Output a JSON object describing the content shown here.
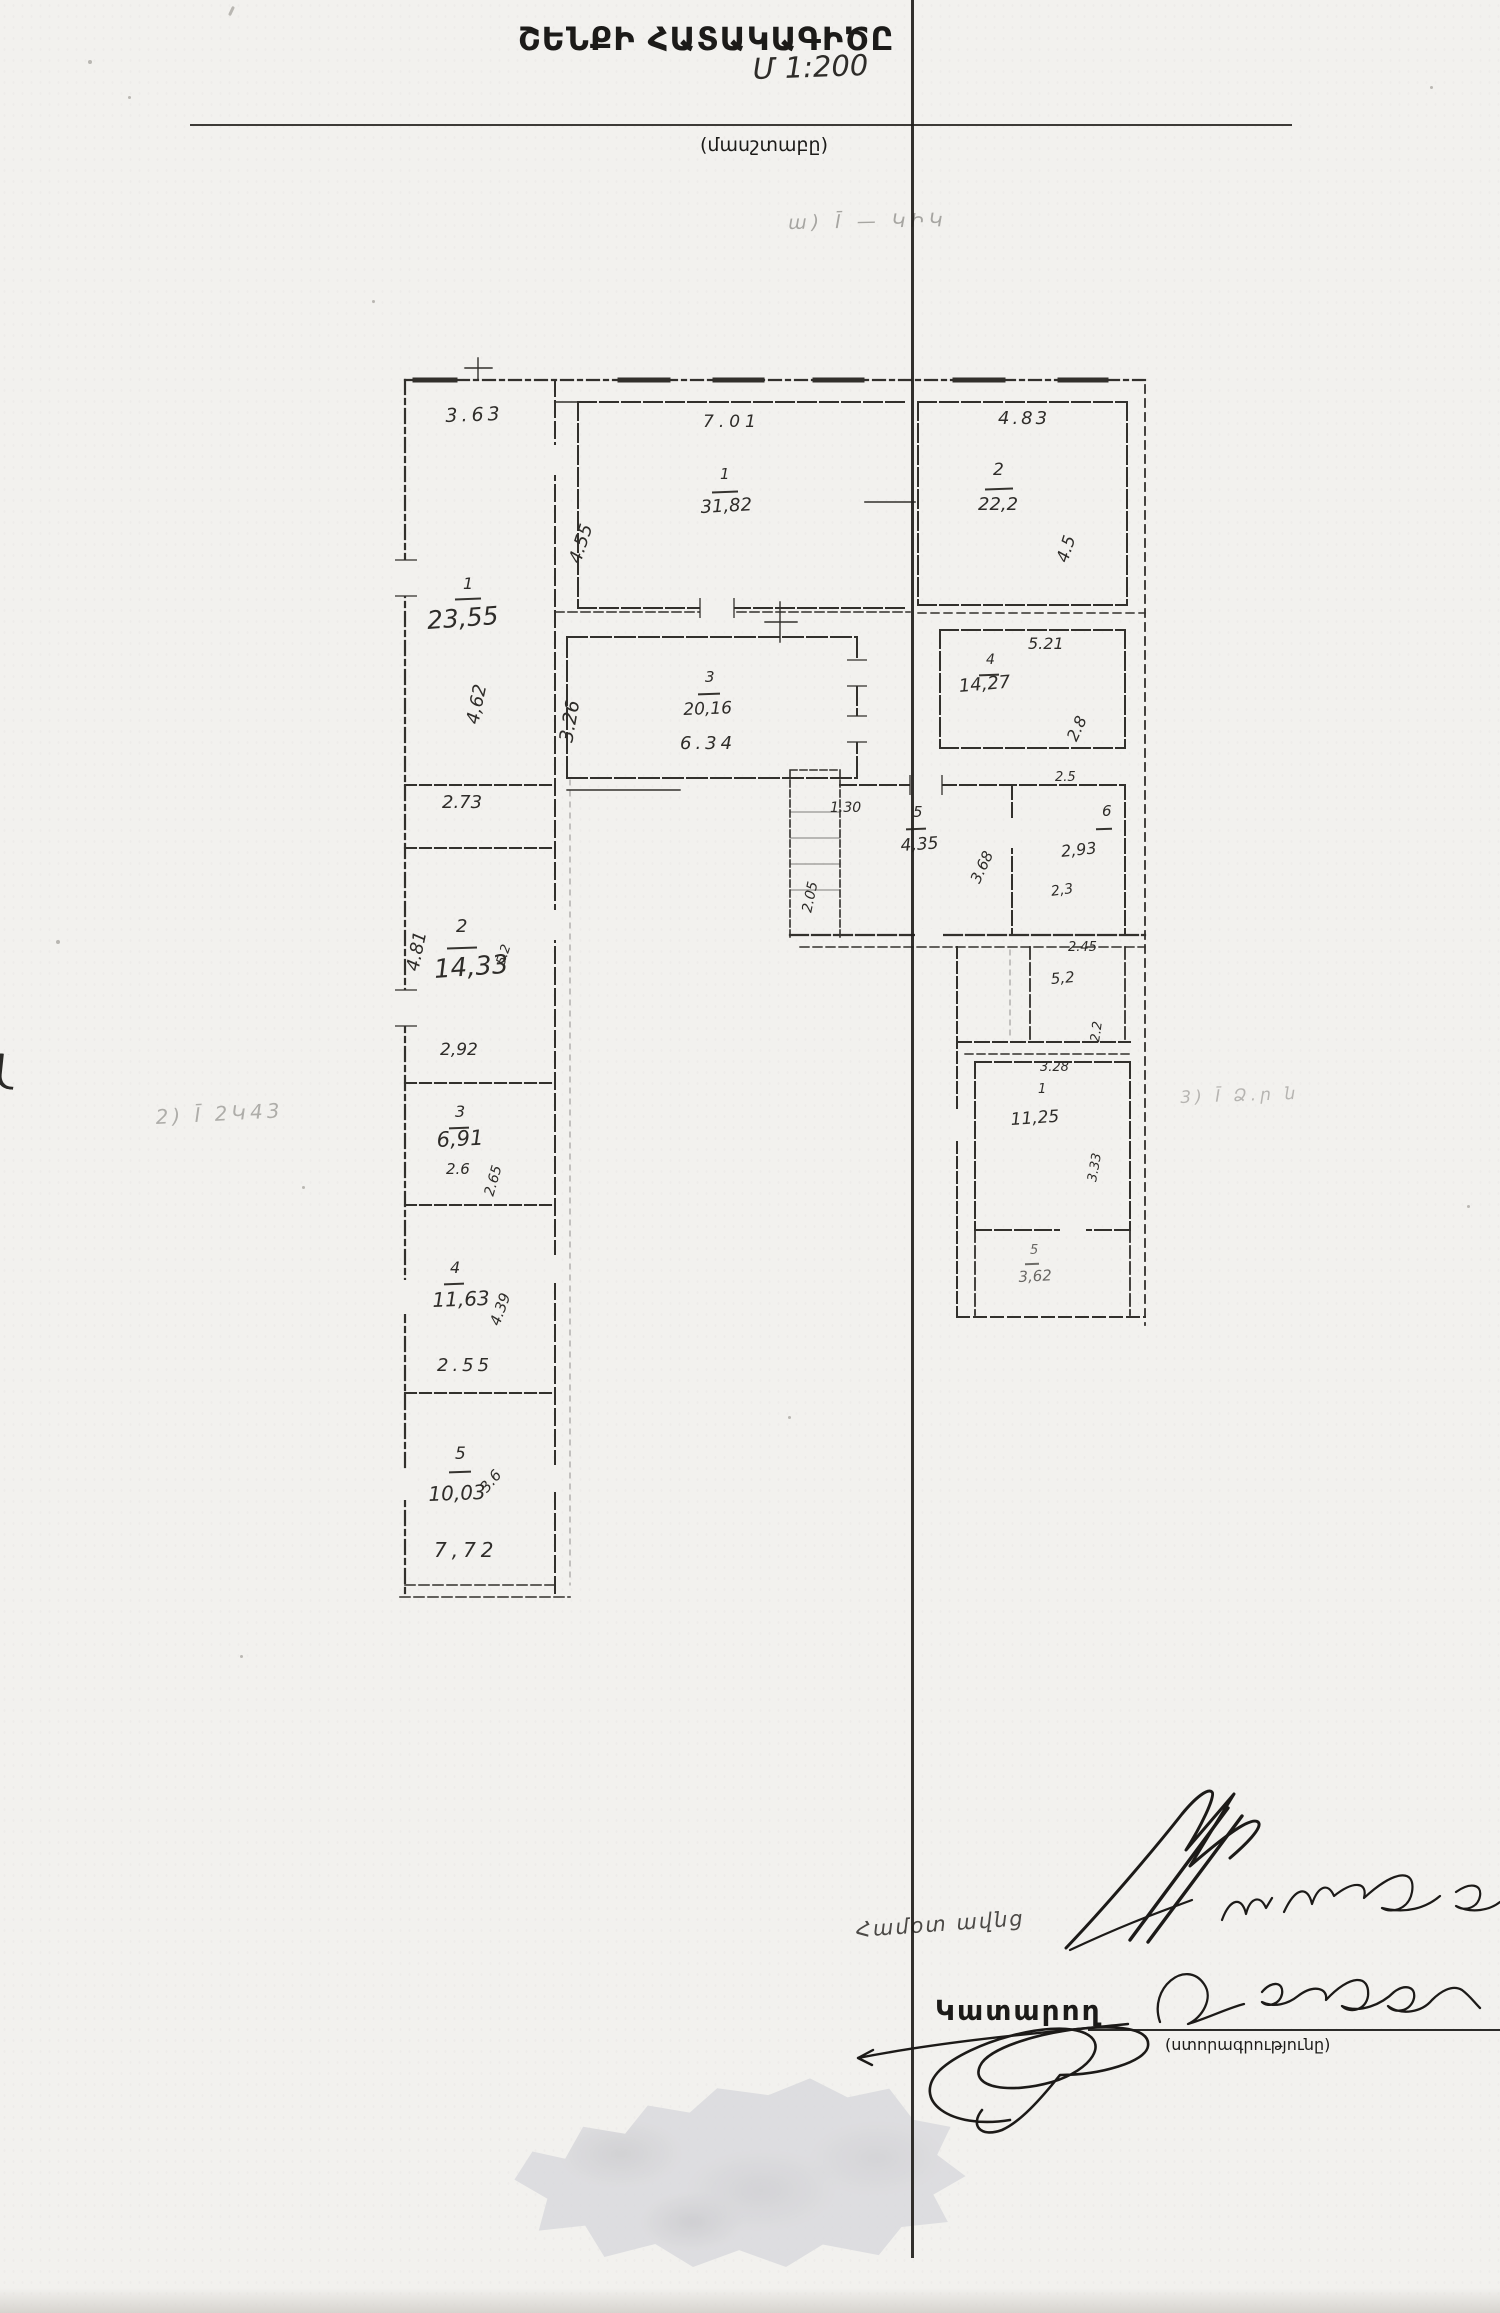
{
  "document": {
    "title": "ՇԵՆՔԻ ՀԱՏԱԿԱԳԻԾԸ",
    "scale_value": "Մ 1:200",
    "scale_caption": "(մասշտաբը)",
    "notes": {
      "top": "ա) Ī — ԿԻԿ",
      "left": "2) Ī  2Կ43",
      "right": "3) Ī  Ձ․ր ն",
      "remark": "Համօտ ավնց"
    },
    "footer": {
      "executor_label": "Կատարող",
      "signature_caption": "(ստորագրությունը)"
    }
  },
  "floor_plan": {
    "rooms": [
      {
        "wing": "left-top",
        "number": "1",
        "area": "23,55",
        "dim_top": "3.63",
        "dim_left": "4,62"
      },
      {
        "wing": "left",
        "number": "2",
        "area": "14,33",
        "dim_top": "2.73",
        "dim_left": "4.81",
        "dim_right": "5.2",
        "dim_bottom": "2,92"
      },
      {
        "wing": "left",
        "number": "3",
        "area": "6,91",
        "dim_bottom": "2.6",
        "dim_right": "2.65"
      },
      {
        "wing": "left",
        "number": "4",
        "area": "11,63",
        "dim_right": "4.39",
        "dim_bottom": "2.55"
      },
      {
        "wing": "left-bottom",
        "number": "5",
        "area": "10,03",
        "dim_right": "3.6",
        "dim_bottom": "7,72"
      },
      {
        "wing": "top-center",
        "number": "1",
        "area": "31,82",
        "dim_top": "7.01",
        "dim_left": "4.55"
      },
      {
        "wing": "top-right",
        "number": "2",
        "area": "22,2",
        "dim_top": "4.83",
        "dim_right": "4.5"
      },
      {
        "wing": "middle",
        "number": "3",
        "area": "20,16",
        "dim_left": "3.26",
        "dim_bottom": "6.34"
      },
      {
        "wing": "middle-right",
        "number": "4",
        "area": "14,27",
        "dim_top": "5.21",
        "dim_right": "2.8"
      },
      {
        "wing": "center",
        "number": "5",
        "area": "4,35",
        "dim_top": "1.30",
        "dim_left": "2.05",
        "dim_right": "3.68"
      },
      {
        "wing": "center-right",
        "number": "6",
        "area": "2,93",
        "dim_top": "2.5",
        "dim_bottom": "2,3"
      },
      {
        "wing": "right",
        "number": "",
        "area": "5,2",
        "dim_top": "2.45",
        "dim_right": "2.2"
      },
      {
        "wing": "right",
        "number": "1",
        "area": "11,25",
        "dim_top": "3.28",
        "dim_right": "3.33"
      },
      {
        "wing": "right-bottom",
        "number": "5",
        "area": "3,62"
      }
    ],
    "ink_color": "#2c2a27",
    "paper_color": "#f2f1ee"
  }
}
